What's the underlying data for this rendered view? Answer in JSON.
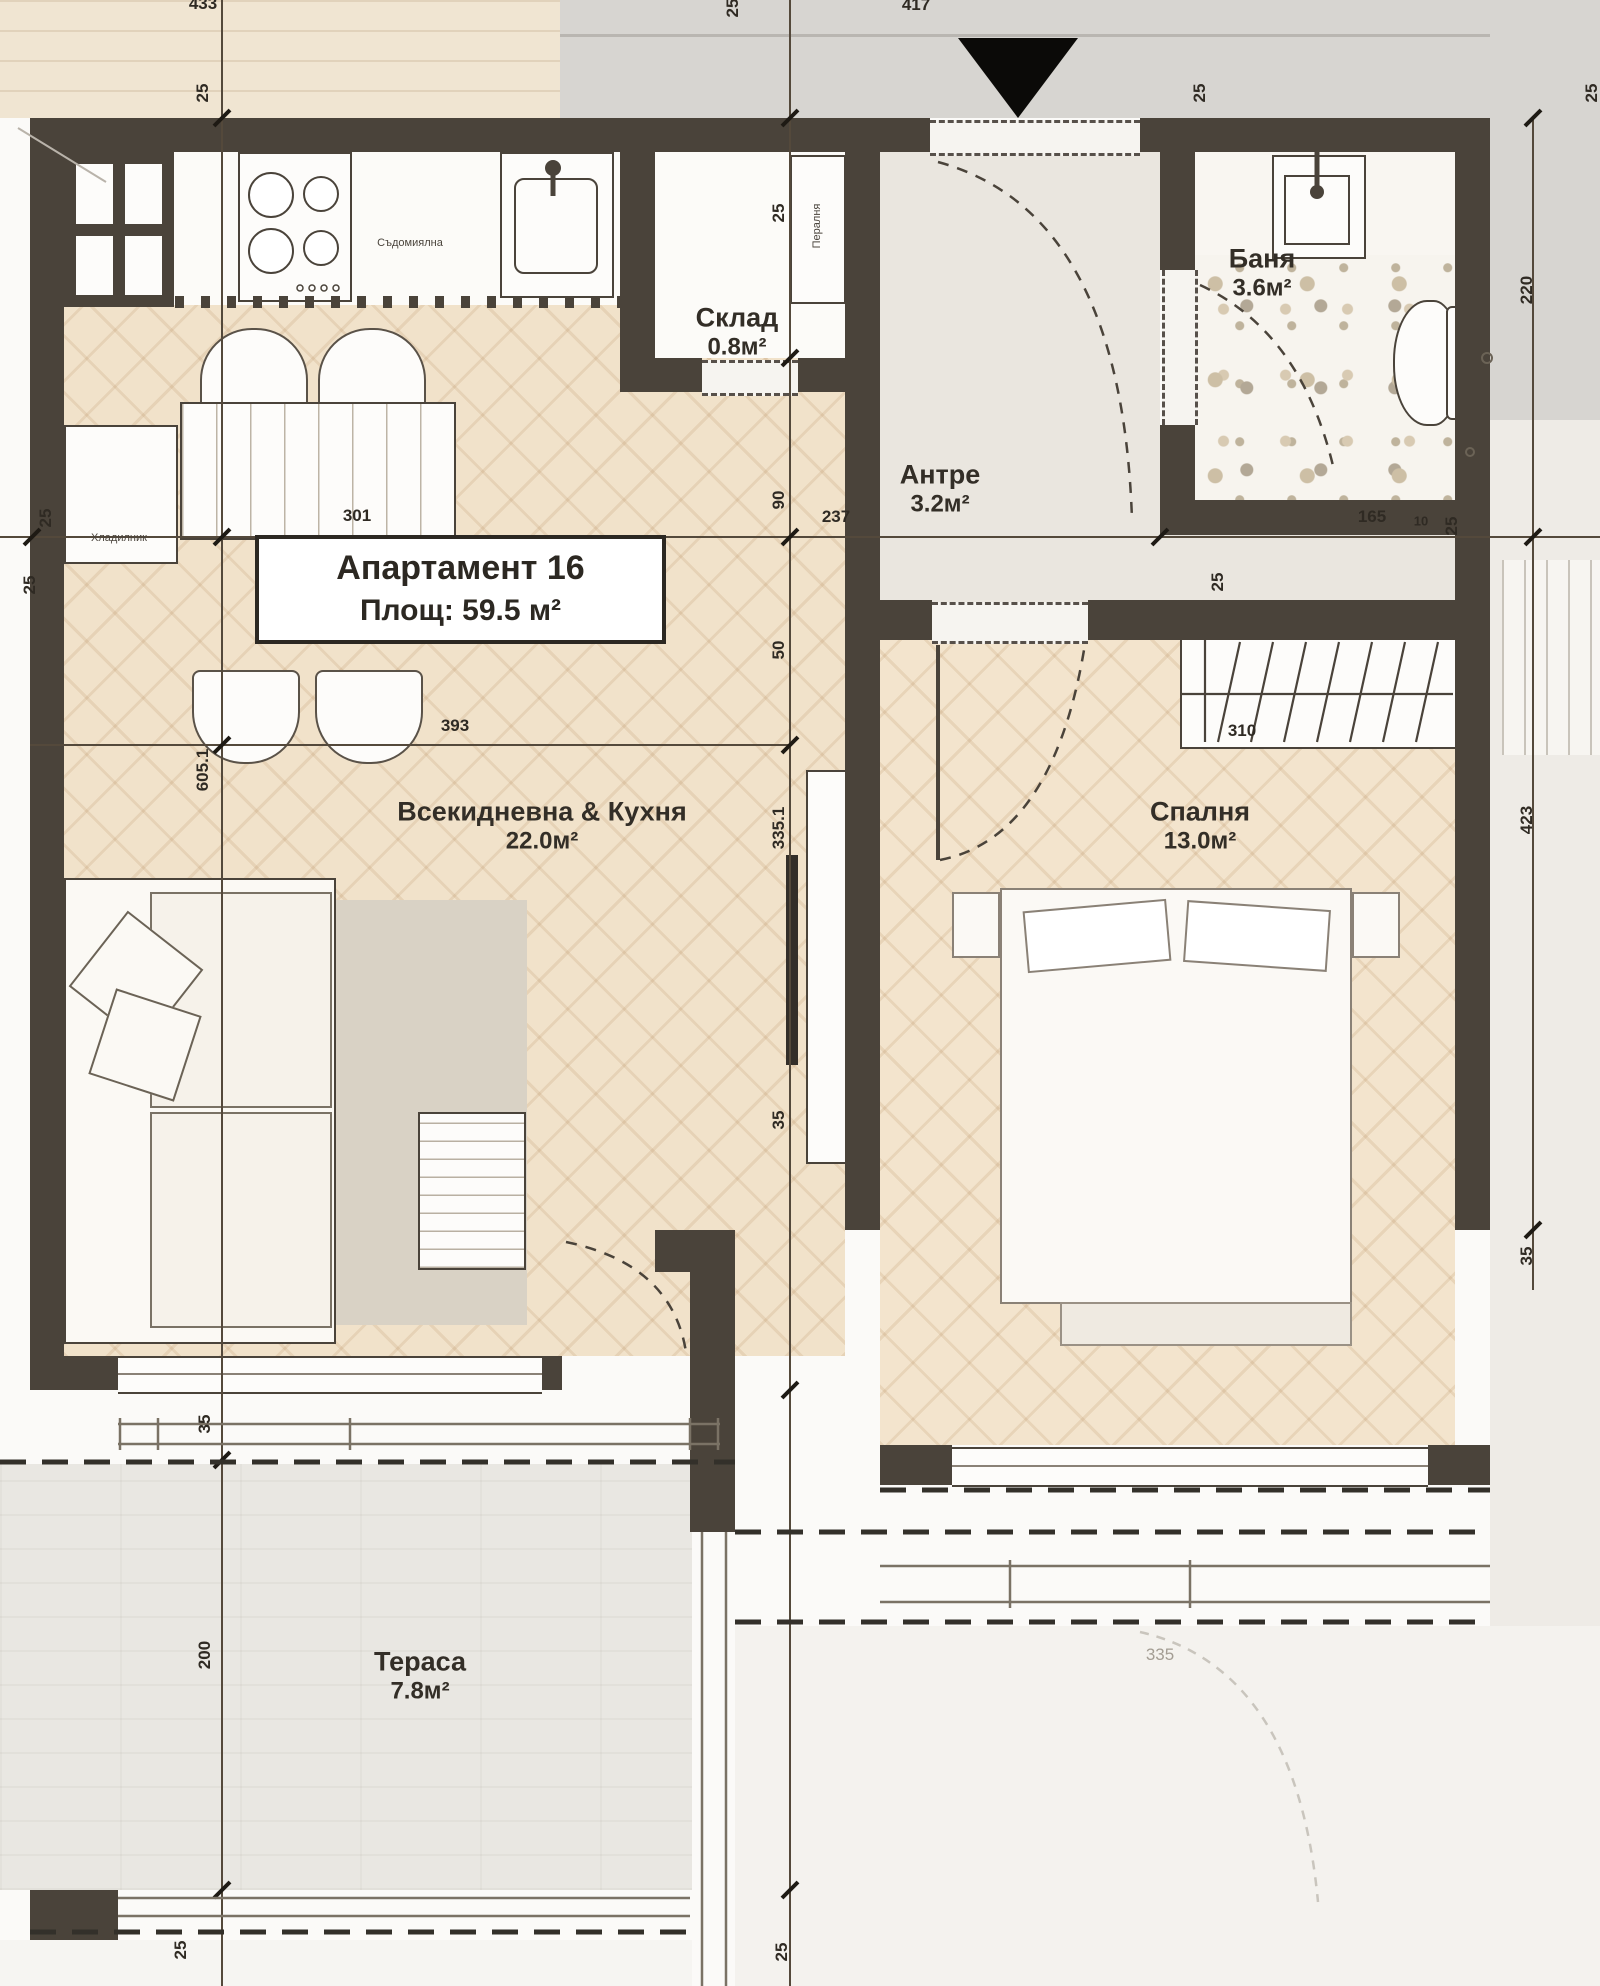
{
  "title_box": {
    "line1": "Апартамент 16",
    "line2": "Площ: 59.5 м²"
  },
  "rooms": [
    {
      "id": "living",
      "name": "Всекидневна & Кухня",
      "area": "22.0м²",
      "x": 542,
      "y": 806,
      "ay": 845
    },
    {
      "id": "bedroom",
      "name": "Спалня",
      "area": "13.0м²",
      "x": 1200,
      "y": 806,
      "ay": 845
    },
    {
      "id": "hall",
      "name": "Антре",
      "area": "3.2м²",
      "x": 940,
      "y": 470,
      "ay": 508
    },
    {
      "id": "bath",
      "name": "Баня",
      "area": "3.6м²",
      "x": 1262,
      "y": 252,
      "ay": 294
    },
    {
      "id": "storage",
      "name": "Склад",
      "area": "0.8м²",
      "x": 737,
      "y": 312,
      "ay": 352
    },
    {
      "id": "terrace",
      "name": "Тераса",
      "area": "7.8м²",
      "x": 420,
      "y": 1652,
      "ay": 1699
    }
  ],
  "fixtures": [
    {
      "id": "dishwasher",
      "label": "Съдомиялна",
      "x": 410,
      "y": 243,
      "rot": false
    },
    {
      "id": "fridge",
      "label": "Хладилник",
      "x": 119,
      "y": 538,
      "rot": false
    },
    {
      "id": "washer",
      "label": "Пералня",
      "x": 817,
      "y": 226,
      "rot": true
    }
  ],
  "dimensions": [
    {
      "t": "433",
      "x": 203,
      "y": 4,
      "rot": false
    },
    {
      "t": "25",
      "x": 733,
      "y": 8,
      "rot": true
    },
    {
      "t": "417",
      "x": 916,
      "y": 5,
      "rot": false
    },
    {
      "t": "25",
      "x": 203,
      "y": 93,
      "rot": true
    },
    {
      "t": "25",
      "x": 1200,
      "y": 93,
      "rot": true
    },
    {
      "t": "25",
      "x": 1592,
      "y": 93,
      "rot": true
    },
    {
      "t": "25",
      "x": 779,
      "y": 213,
      "rot": true
    },
    {
      "t": "220",
      "x": 1527,
      "y": 290,
      "rot": true
    },
    {
      "t": "25",
      "x": 46,
      "y": 518,
      "rot": true
    },
    {
      "t": "301",
      "x": 357,
      "y": 516,
      "rot": false
    },
    {
      "t": "237",
      "x": 836,
      "y": 517,
      "rot": false
    },
    {
      "t": "165",
      "x": 1372,
      "y": 517,
      "rot": false
    },
    {
      "t": "10",
      "x": 1421,
      "y": 521,
      "rot": false,
      "cls": "tiny"
    },
    {
      "t": "25",
      "x": 1452,
      "y": 526,
      "rot": true
    },
    {
      "t": "25",
      "x": 30,
      "y": 585,
      "rot": true
    },
    {
      "t": "25",
      "x": 1218,
      "y": 582,
      "rot": true
    },
    {
      "t": "90",
      "x": 779,
      "y": 500,
      "rot": true
    },
    {
      "t": "50",
      "x": 779,
      "y": 650,
      "rot": true
    },
    {
      "t": "393",
      "x": 455,
      "y": 726,
      "rot": false
    },
    {
      "t": "605.1",
      "x": 203,
      "y": 770,
      "rot": true
    },
    {
      "t": "310",
      "x": 1242,
      "y": 731,
      "rot": false
    },
    {
      "t": "335.1",
      "x": 779,
      "y": 828,
      "rot": true
    },
    {
      "t": "423",
      "x": 1527,
      "y": 820,
      "rot": true
    },
    {
      "t": "35",
      "x": 779,
      "y": 1120,
      "rot": true
    },
    {
      "t": "35",
      "x": 1527,
      "y": 1256,
      "rot": true
    },
    {
      "t": "35",
      "x": 205,
      "y": 1424,
      "rot": true
    },
    {
      "t": "200",
      "x": 205,
      "y": 1655,
      "rot": true
    },
    {
      "t": "335",
      "x": 1160,
      "y": 1655,
      "rot": false,
      "cls": "gray"
    },
    {
      "t": "25",
      "x": 181,
      "y": 1950,
      "rot": true
    },
    {
      "t": "25",
      "x": 782,
      "y": 1952,
      "rot": true
    }
  ],
  "colors": {
    "wall": "#4a433a",
    "parquet": "#f1e2ca",
    "corridor": "#d7d5d1",
    "label_ink": "#2f2a23"
  }
}
